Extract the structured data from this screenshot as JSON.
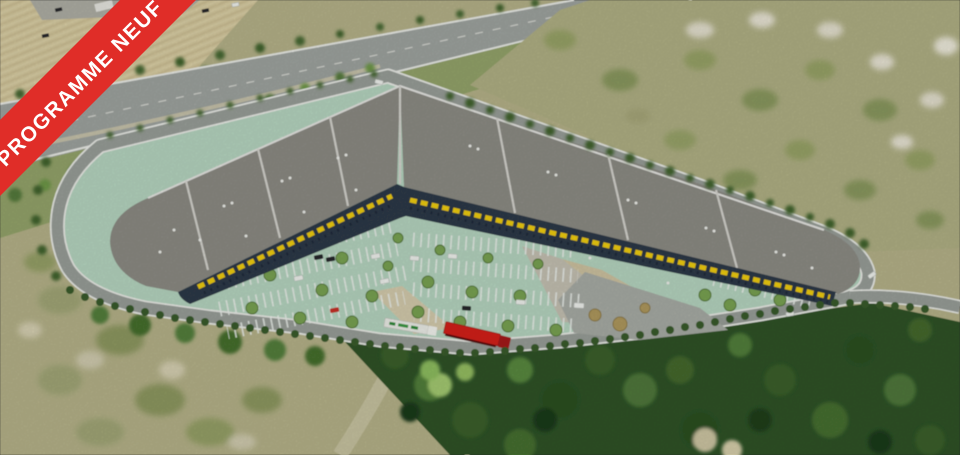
{
  "ribbon": {
    "label": "PROGRAMME NEUF",
    "bg_color": "#e02d28",
    "text_color": "#ffffff"
  },
  "scene": {
    "type": "aerial-photo-with-architectural-render",
    "colors": {
      "field_tan": "#d9cda2",
      "furrow": "#c7b98d",
      "highway_gray": "#a0a5a1",
      "road_gray": "#9aa09a",
      "road_edge_white": "#eceee9",
      "green_strip": "#95a56b",
      "scrub": "#b7b48a",
      "scrub_pale": "#e7e3d1",
      "forest_dark": "#2f5428",
      "forest_light": "#6f9e48",
      "parking_mint": "#b7d7c1",
      "parking_stripe": "#eef3ee",
      "apron_gray": "#a9ada6",
      "plaza_beige": "#cfc4a2",
      "roof_gray": "#8e8d86",
      "roof_ridge": "#d7d6d0",
      "facade_navy": "#2e3a48",
      "accent_yellow": "#f2cf12",
      "truck_red": "#d61e1a",
      "truck_white": "#edefe9",
      "tree_dark": "#3a5c2c",
      "tree_parking": "#7aa452"
    }
  }
}
